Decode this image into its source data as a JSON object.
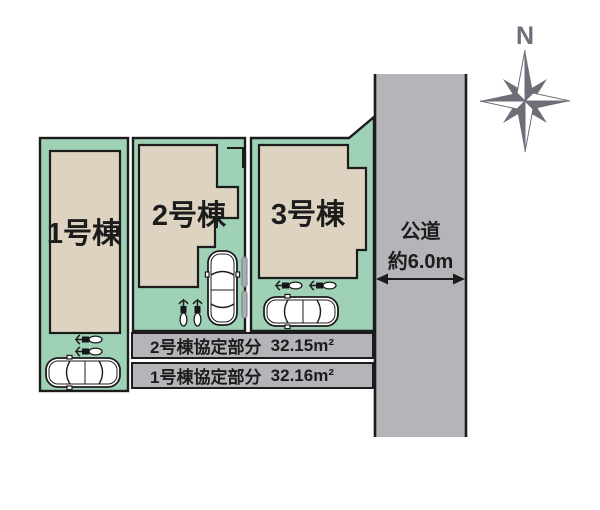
{
  "lots": {
    "lot1": {
      "label": "1号棟"
    },
    "lot2": {
      "label": "2号棟"
    },
    "lot3": {
      "label": "3号棟"
    }
  },
  "road": {
    "name": "公道",
    "width_label": "約6.0m"
  },
  "compass": {
    "north_label": "N"
  },
  "agreement_rows": [
    {
      "label": "2号棟協定部分",
      "area": "32.15m²"
    },
    {
      "label": "1号棟協定部分",
      "area": "32.16m²"
    }
  ],
  "icons": {
    "compass": "compass-rose-icon",
    "car": "car-top-view-icon",
    "bicycle": "bicycle-top-view-icon",
    "road_width_arrow": "width-arrow-icon"
  },
  "colors": {
    "lot_fill": "#9fd1b6",
    "building_fill": "#ded3c0",
    "road_fill": "#b4b4b9",
    "outline": "#1c1c1c",
    "compass_color": "#6e6e78"
  }
}
